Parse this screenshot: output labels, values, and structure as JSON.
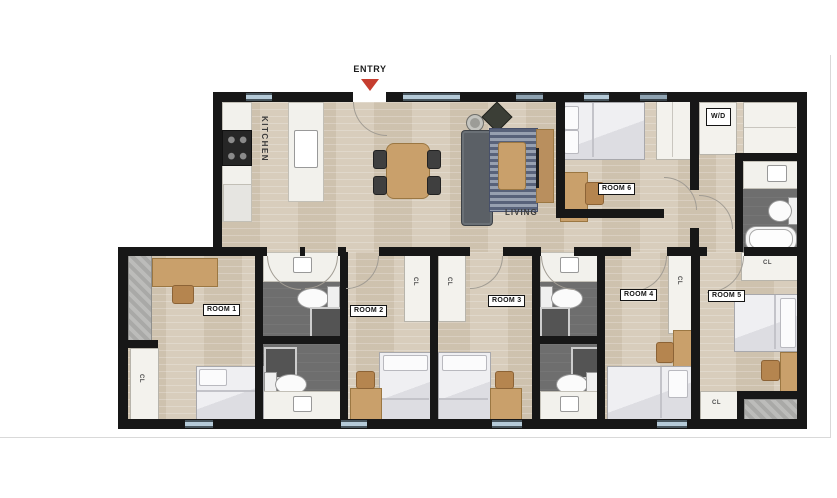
{
  "floor_plan": {
    "entry": {
      "label": "ENTRY"
    },
    "kitchen": {
      "label": "KITCHEN"
    },
    "living": {
      "label": "LIVING"
    },
    "laundry": {
      "label": "W/D"
    },
    "closet_label": "CL",
    "rooms": [
      {
        "id": "room-1",
        "label": "ROOM 1"
      },
      {
        "id": "room-2",
        "label": "ROOM 2"
      },
      {
        "id": "room-3",
        "label": "ROOM 3"
      },
      {
        "id": "room-4",
        "label": "ROOM 4"
      },
      {
        "id": "room-5",
        "label": "ROOM 5"
      },
      {
        "id": "room-6",
        "label": "ROOM 6"
      }
    ],
    "colors": {
      "wall": "#171717",
      "wood_floor": "#d6cab8",
      "bath_floor": "#6e6e6e",
      "window": "#b5cad8",
      "window_dark": "#8fa3b2",
      "entry_arrow": "#c63d2f",
      "wood_furniture": "#c9a06b",
      "fixture_white": "#f3f2ed"
    }
  }
}
